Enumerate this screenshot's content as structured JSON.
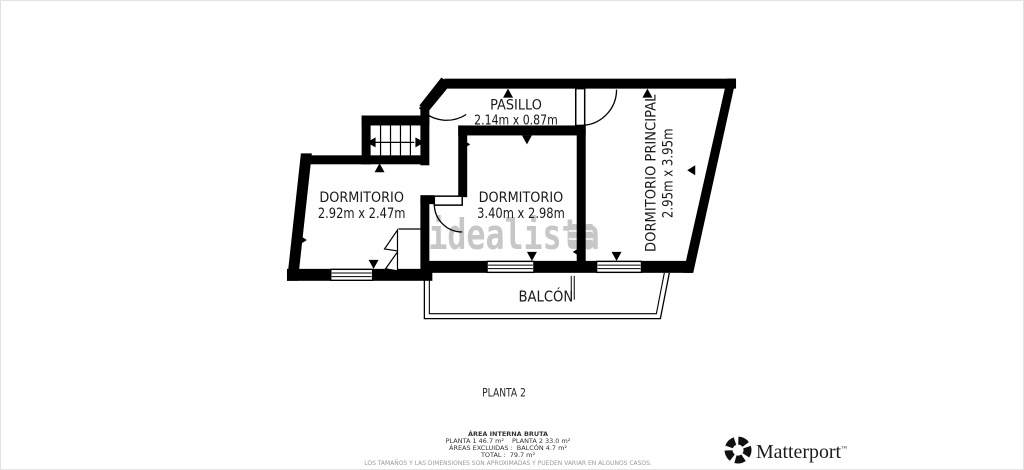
{
  "canvas": {
    "background": "#ffffff",
    "wall_color": "#000000",
    "watermark_color": "#c7c7c7",
    "text_color": "#1a1a1a"
  },
  "watermark": {
    "text": "idealista"
  },
  "rooms": {
    "pasillo": {
      "name": "PASILLO",
      "dims": "2.14m x 0.87m"
    },
    "dormitorio_left": {
      "name": "DORMITORIO",
      "dims": "2.92m x 2.47m"
    },
    "dormitorio_centro": {
      "name": "DORMITORIO",
      "dims": "3.40m x 2.98m"
    },
    "dormitorio_principal": {
      "name": "DORMITORIO PRINCIPAL",
      "dims": "2.95m x 3.95m"
    },
    "balcon": {
      "name": "BALCÓN"
    }
  },
  "floor": {
    "label": "PLANTA 2"
  },
  "footer": {
    "area_title": "ÁREA INTERNA BRUTA",
    "planta1": "PLANTA 1 46.7 m²",
    "planta2": "PLANTA 2 33.0 m²",
    "excluded_label": "ÁREAS EXCLUIDAS :",
    "excluded_value": "BALCÓN 4.7 m²",
    "total_label": "TOTAL :",
    "total_value": "79.7 m²",
    "disclaimer": "LOS TAMAÑOS Y LAS DIMENSIONES SON APROXIMADAS Y PUEDEN VARIAR EN ALGUNOS CASOS."
  },
  "branding": {
    "name": "Matterport",
    "trademark": "™"
  }
}
